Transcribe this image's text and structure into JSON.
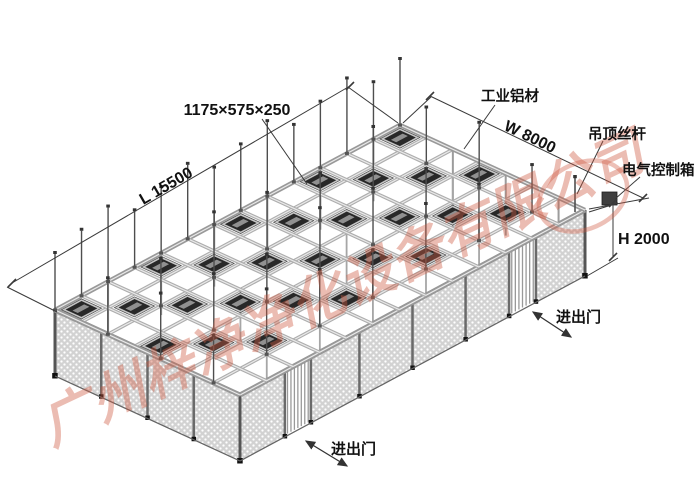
{
  "diagram": {
    "dimensions": {
      "module": "1175×575×250",
      "length": "L 15500",
      "width": "W 8000",
      "height": "H 2000"
    },
    "labels": {
      "aluminum_profile": "工业铝材",
      "ceiling_rod": "吊顶丝杆",
      "electrical_box": "电气控制箱",
      "door_right": "进出门",
      "door_front": "进出门"
    },
    "watermark": "广州梓净净化设备有限公司",
    "colors": {
      "line": "#3a3a3a",
      "beam": "#adadad",
      "beam_highlight": "#e9e9e9",
      "beam_edge": "#999999",
      "ffu_dark": "#282828",
      "ffu_frame": "#c6c6c6",
      "ffu_slot": "#909090",
      "wall_fill": "#d2d2d2",
      "post": "#6a6a6a",
      "foot": "#111111",
      "watermark": "#cf5a41",
      "label": "#111111"
    }
  }
}
